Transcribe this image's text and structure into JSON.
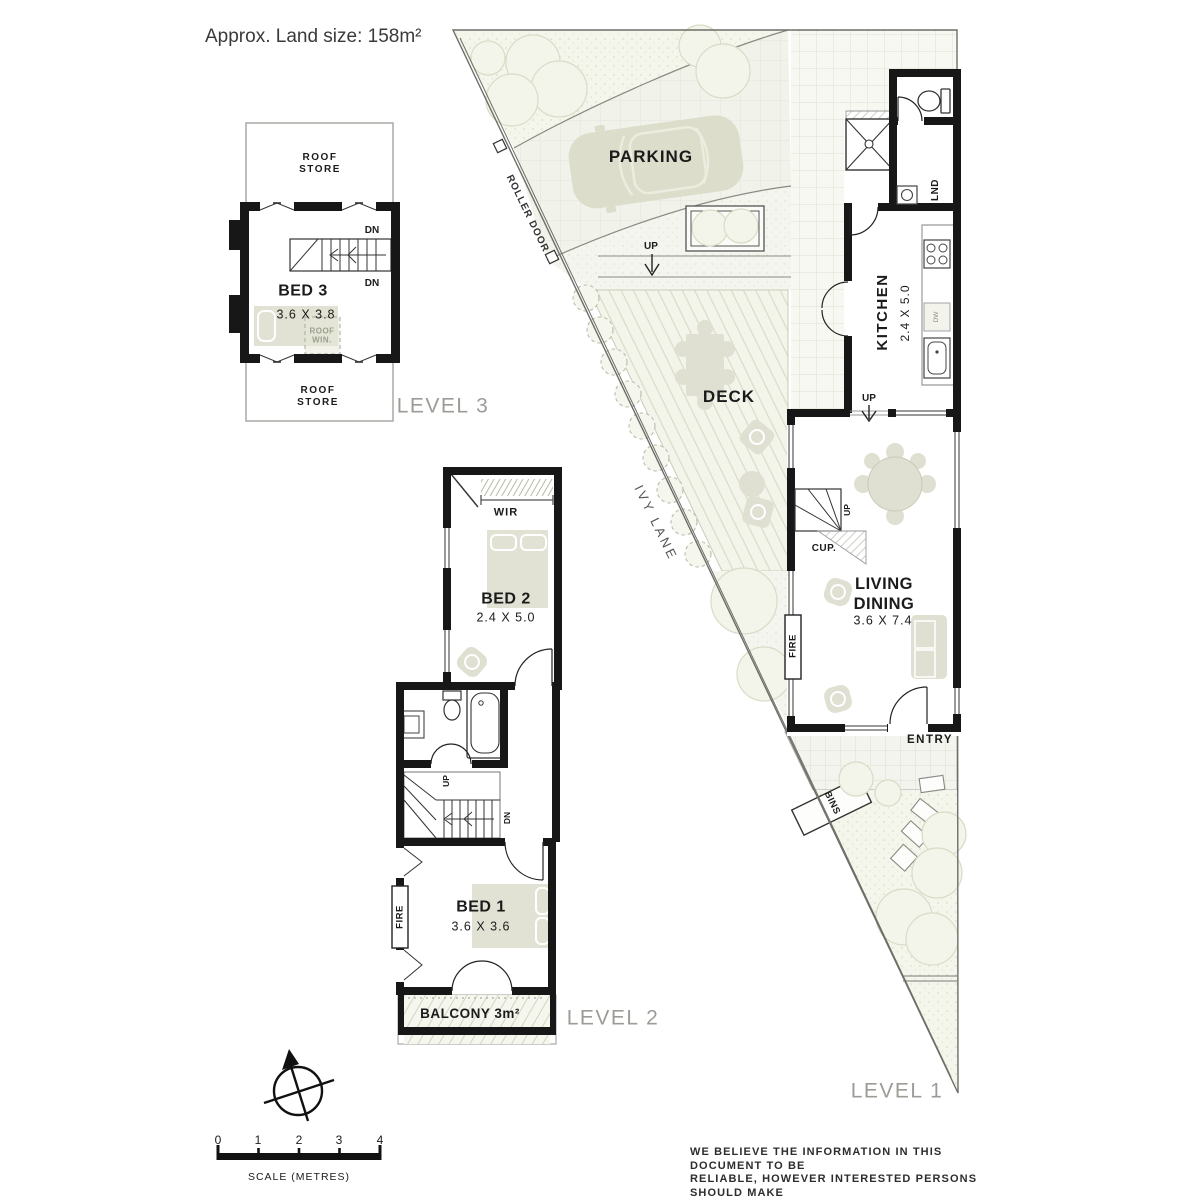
{
  "header": {
    "land_size": "Approx. Land size: 158m²"
  },
  "level3": {
    "label": "LEVEL 3",
    "roof_store_top": "ROOF\nSTORE",
    "roof_store_bottom": "ROOF\nSTORE",
    "room": "BED 3",
    "dim": "3.6 X 3.8",
    "dn_upper": "DN",
    "dn_lower": "DN",
    "roof_win": "ROOF\nWIN."
  },
  "level2": {
    "label": "LEVEL 2",
    "wir": "WIR",
    "bed2": "BED 2",
    "bed2_dim": "2.4 X 5.0",
    "up": "UP",
    "dn": "DN",
    "fire": "FIRE",
    "bed1": "BED 1",
    "bed1_dim": "3.6 X 3.6",
    "balcony": "BALCONY 3m²"
  },
  "level1": {
    "label": "LEVEL 1",
    "parking": "PARKING",
    "roller_door": "ROLLER DOOR",
    "ivy_lane": "IVY LANE",
    "up_parking": "UP",
    "deck": "DECK",
    "kitchen": "KITCHEN",
    "kitchen_dim": "2.4 X 5.0",
    "lnd": "LND",
    "dw": "DW",
    "up_kitchen": "UP",
    "up_stairs": "UP",
    "cup": "CUP.",
    "living": "LIVING\nDINING",
    "living_dim": "3.6 X 7.4",
    "fire": "FIRE",
    "entry": "ENTRY",
    "bins": "BINS"
  },
  "scale": {
    "ticks": [
      "0",
      "1",
      "2",
      "3",
      "4"
    ],
    "label": "SCALE (METRES)"
  },
  "disclaimer": {
    "line1": "WE BELIEVE THE INFORMATION IN THIS DOCUMENT TO BE",
    "line2": "RELIABLE, HOWEVER INTERESTED PERSONS SHOULD MAKE",
    "line3": "THEIR OWN ENQUIRIES. DIMENSIONS ARE APPROXIMATE."
  }
}
